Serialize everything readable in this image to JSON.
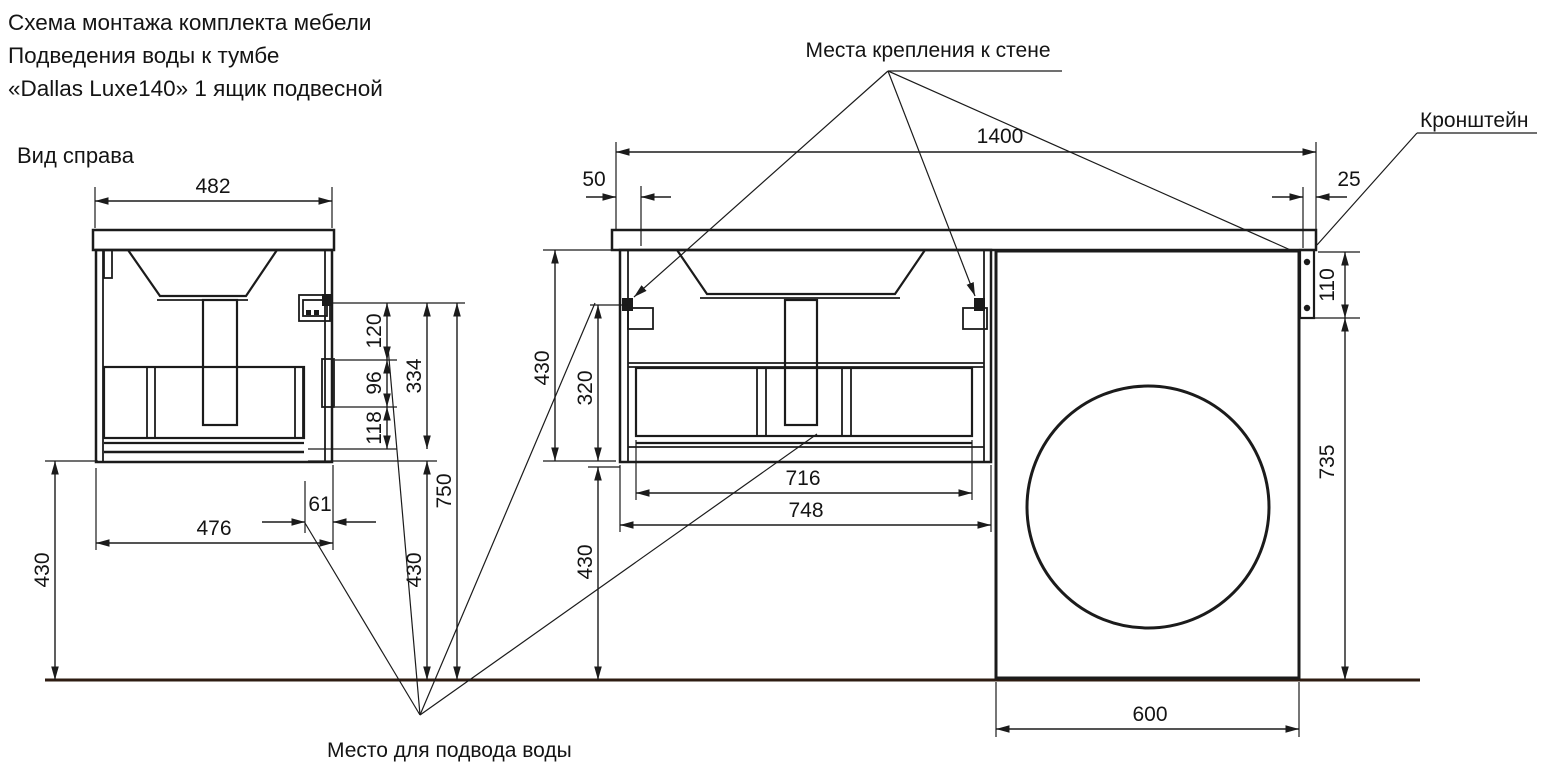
{
  "title": {
    "line1": "Схема монтажа комплекта мебели",
    "line2": "Подведения воды к тумбе",
    "line3": "«Dallas Luxe140» 1 ящик подвесной"
  },
  "labels": {
    "side_view": "Вид справа",
    "wall_mount_points": "Места крепления к стене",
    "bracket": "Кронштейн",
    "water_supply": "Место для подвода воды"
  },
  "side_view": {
    "dims": {
      "countertop_width": "482",
      "mount_offset": "120",
      "rail_height": "96",
      "lower_offset": "118",
      "mount_to_bottom": "334",
      "mount_height": "750",
      "under_clearance": "430",
      "floor_clearance": "430",
      "depth": "476",
      "wall_offset": "61"
    }
  },
  "front_view": {
    "dims": {
      "countertop_width": "1400",
      "mount_edge_offset": "50",
      "bracket_edge_offset": "25",
      "bracket_height": "110",
      "cabinet_height": "430",
      "mount_to_bottom": "320",
      "drawer_width": "716",
      "cabinet_width": "748",
      "under_clearance": "430",
      "bracket_to_floor": "735",
      "machine_width": "600"
    }
  }
}
